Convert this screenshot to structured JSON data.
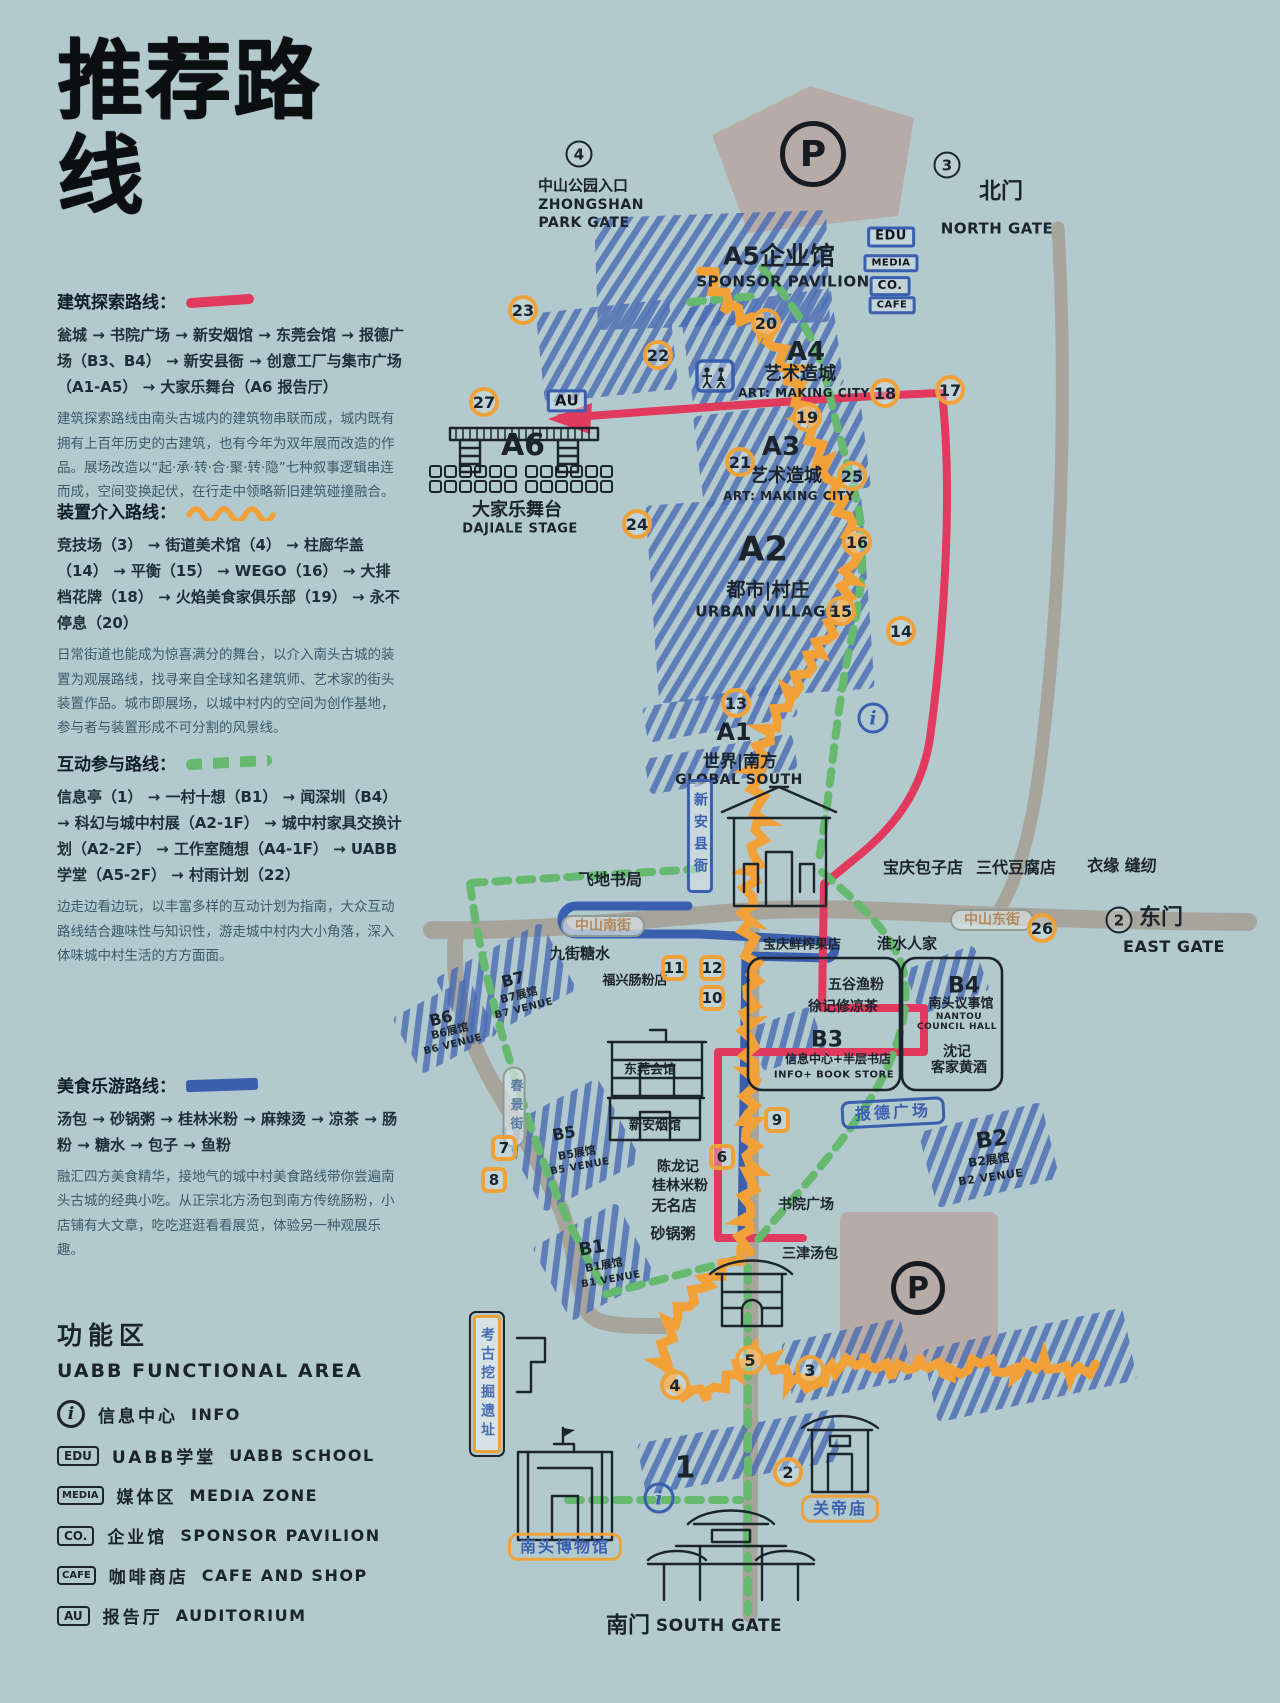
{
  "title": "推荐路线",
  "colors": {
    "background": "#b2c9ce",
    "ink": "#1b242c",
    "route_red": "#e23a5e",
    "route_orange": "#f2a138",
    "route_green": "#66b96f",
    "route_blue": "#3a5fae",
    "hatch_blue": "#4a6cb3",
    "road_gray": "#a7a49b",
    "parking_gray": "#b6aba6",
    "badge_orange": "#f0a23a"
  },
  "routes": [
    {
      "name": "建筑探索路线：",
      "stops": "瓮城 → 书院广场 → 新安烟馆 → 东莞会馆 → 报德广场（B3、B4） → 新安县衙 → 创意工厂与集市广场（A1-A5） → 大家乐舞台（A6 报告厅）",
      "desc": "建筑探索路线由南头古城内的建筑物串联而成，城内既有拥有上百年历史的古建筑，也有今年为双年展而改造的作品。展场改造以“起·承·转·合·聚·转·隐”七种叙事逻辑串连而成，空间变换起伏，在行走中领略新旧建筑碰撞融合。"
    },
    {
      "name": "装置介入路线：",
      "stops": "竞技场（3） → 街道美术馆（4） → 柱廊华盖（14） → 平衡（15） → WEGO（16） → 大排档花牌（18） → 火焰美食家俱乐部（19） → 永不停息（20）",
      "desc": "日常街道也能成为惊喜满分的舞台，以介入南头古城的装置为观展路线，找寻来自全球知名建筑师、艺术家的街头装置作品。城市即展场，以城中村内的空间为创作基地，参与者与装置形成不可分割的风景线。"
    },
    {
      "name": "互动参与路线：",
      "stops": "信息亭（1） → 一村十想（B1） → 闻深圳（B4） → 科幻与城中村展（A2-1F） → 城中村家具交换计划（A2-2F） → 工作室随想（A4-1F） → UABB 学堂（A5-2F） → 村雨计划（22）",
      "desc": "边走边看边玩，以丰富多样的互动计划为指南，大众互动路线结合趣味性与知识性，游走城中村内大小角落，深入体味城中村生活的方方面面。"
    },
    {
      "name": "美食乐游路线：",
      "stops": "汤包 → 砂锅粥 → 桂林米粉 → 麻辣烫 → 凉茶 → 肠粉 → 糖水 → 包子 → 鱼粉",
      "desc": "融汇四方美食精华，接地气的城中村美食路线带你尝遍南头古城的经典小吃。从正宗北方汤包到南方传统肠粉，小店铺有大文章，吃吃逛逛看看展览，体验另一种观展乐趣。"
    }
  ],
  "legend": {
    "title_cn": "功能区",
    "title_en": "UABB FUNCTIONAL AREA",
    "items": [
      {
        "icon": "i",
        "cn": "信息中心",
        "en": "INFO"
      },
      {
        "icon": "EDU",
        "cn": "UABB学堂",
        "en": "UABB SCHOOL"
      },
      {
        "icon": "MEDIA",
        "cn": "媒体区",
        "en": "MEDIA ZONE"
      },
      {
        "icon": "CO.",
        "cn": "企业馆",
        "en": "SPONSOR PAVILION"
      },
      {
        "icon": "CAFE",
        "cn": "咖啡商店",
        "en": "CAFE AND SHOP"
      },
      {
        "icon": "AU",
        "cn": "报告厅",
        "en": "AUDITORIUM"
      }
    ]
  },
  "map": {
    "labels": [
      {
        "t": "中山公园入口",
        "x": 583,
        "y": 186,
        "fs": 15
      },
      {
        "t": "ZHONGSHAN",
        "x": 591,
        "y": 205,
        "fs": 14,
        "cls": "latin"
      },
      {
        "t": "PARK GATE",
        "x": 584,
        "y": 223,
        "fs": 14,
        "cls": "latin"
      },
      {
        "t": "北门",
        "x": 1001,
        "y": 192,
        "fs": 22
      },
      {
        "t": "NORTH GATE",
        "x": 997,
        "y": 229,
        "fs": 15,
        "cls": "latin"
      },
      {
        "t": "A5企业馆",
        "x": 779,
        "y": 257,
        "fs": 25
      },
      {
        "t": "SPONSOR PAVILION",
        "x": 783,
        "y": 282,
        "fs": 15,
        "cls": "latin"
      },
      {
        "t": "EDU",
        "x": 891,
        "y": 237,
        "fs": 13,
        "cls": "fac"
      },
      {
        "t": "MEDIA",
        "x": 891,
        "y": 263,
        "fs": 10,
        "cls": "fac"
      },
      {
        "t": "CO.",
        "x": 890,
        "y": 286,
        "fs": 12,
        "cls": "fac"
      },
      {
        "t": "CAFE",
        "x": 892,
        "y": 305,
        "fs": 10,
        "cls": "fac"
      },
      {
        "t": "A4",
        "x": 806,
        "y": 353,
        "fs": 26
      },
      {
        "t": "艺术造城",
        "x": 800,
        "y": 375,
        "fs": 18
      },
      {
        "t": "ART: MAKING CITY",
        "x": 804,
        "y": 394,
        "fs": 12,
        "cls": "latin"
      },
      {
        "t": "AU",
        "x": 567,
        "y": 401,
        "fs": 15,
        "cls": "fac"
      },
      {
        "t": "A6",
        "x": 523,
        "y": 446,
        "fs": 30
      },
      {
        "t": "大家乐舞台",
        "x": 517,
        "y": 511,
        "fs": 18
      },
      {
        "t": "DAJIALE STAGE",
        "x": 520,
        "y": 530,
        "fs": 13,
        "cls": "latin"
      },
      {
        "t": "A3",
        "x": 781,
        "y": 448,
        "fs": 26
      },
      {
        "t": "艺术造城",
        "x": 786,
        "y": 477,
        "fs": 18
      },
      {
        "t": "ART: MAKING CITY",
        "x": 789,
        "y": 497,
        "fs": 12,
        "cls": "latin"
      },
      {
        "t": "A2",
        "x": 763,
        "y": 550,
        "fs": 34
      },
      {
        "t": "都市|村庄",
        "x": 768,
        "y": 591,
        "fs": 19
      },
      {
        "t": "URBAN VILLAGE",
        "x": 766,
        "y": 612,
        "fs": 15,
        "cls": "latin"
      },
      {
        "t": "A1",
        "x": 734,
        "y": 733,
        "fs": 24
      },
      {
        "t": "世界|南方",
        "x": 740,
        "y": 763,
        "fs": 17
      },
      {
        "t": "GLOBAL SOUTH",
        "x": 739,
        "y": 780,
        "fs": 14,
        "cls": "latin"
      },
      {
        "t": "飞地书局",
        "x": 610,
        "y": 880,
        "fs": 16
      },
      {
        "t": "新安县衙",
        "x": 700,
        "y": 836,
        "fs": 14,
        "cls": "bannerb"
      },
      {
        "t": "宝庆包子店",
        "x": 923,
        "y": 868,
        "fs": 16
      },
      {
        "t": "三代豆腐店",
        "x": 1016,
        "y": 868,
        "fs": 16
      },
      {
        "t": "衣缘 缝纫",
        "x": 1122,
        "y": 866,
        "fs": 16
      },
      {
        "t": "东门",
        "x": 1161,
        "y": 918,
        "fs": 22
      },
      {
        "t": "EAST GATE",
        "x": 1174,
        "y": 947,
        "fs": 16,
        "cls": "latin"
      },
      {
        "t": "中山东街",
        "x": 992,
        "y": 920,
        "fs": 14,
        "cls": "oval"
      },
      {
        "t": "中山南街",
        "x": 603,
        "y": 926,
        "fs": 14,
        "cls": "oval"
      },
      {
        "t": "九街糖水",
        "x": 580,
        "y": 954,
        "fs": 15
      },
      {
        "t": "淮水人家",
        "x": 907,
        "y": 944,
        "fs": 15
      },
      {
        "t": "宝庆鲜榨果店",
        "x": 802,
        "y": 946,
        "fs": 13
      },
      {
        "t": "福兴肠粉店",
        "x": 635,
        "y": 982,
        "fs": 13
      },
      {
        "t": "五谷渔粉",
        "x": 856,
        "y": 985,
        "fs": 14
      },
      {
        "t": "徐记修凉茶",
        "x": 843,
        "y": 1007,
        "fs": 14
      },
      {
        "t": "B4",
        "x": 964,
        "y": 986,
        "fs": 22
      },
      {
        "t": "南头议事馆",
        "x": 961,
        "y": 1005,
        "fs": 13
      },
      {
        "t": "NANTOU",
        "x": 959,
        "y": 1017,
        "fs": 9,
        "cls": "latin"
      },
      {
        "t": "COUNCIL HALL",
        "x": 957,
        "y": 1027,
        "fs": 9,
        "cls": "latin"
      },
      {
        "t": "沈记",
        "x": 957,
        "y": 1052,
        "fs": 14
      },
      {
        "t": "客家黄酒",
        "x": 959,
        "y": 1068,
        "fs": 14
      },
      {
        "t": "B3",
        "x": 827,
        "y": 1040,
        "fs": 22
      },
      {
        "t": "信息中心+半层书店",
        "x": 838,
        "y": 1060,
        "fs": 12
      },
      {
        "t": "INFO+ BOOK STORE",
        "x": 834,
        "y": 1075,
        "fs": 10,
        "cls": "latin"
      },
      {
        "t": "报德广场",
        "x": 893,
        "y": 1113,
        "fs": 16,
        "cls": "plateb",
        "r": -3
      },
      {
        "t": "B2",
        "x": 992,
        "y": 1140,
        "fs": 22,
        "r": -8
      },
      {
        "t": "B2展馆",
        "x": 989,
        "y": 1161,
        "fs": 12,
        "r": -8
      },
      {
        "t": "B2 VENUE",
        "x": 991,
        "y": 1178,
        "fs": 11,
        "cls": "latin",
        "r": -8
      },
      {
        "t": "B7",
        "x": 513,
        "y": 980,
        "fs": 16,
        "r": -14
      },
      {
        "t": "B7展馆",
        "x": 519,
        "y": 996,
        "fs": 11,
        "r": -14
      },
      {
        "t": "B7 VENUE",
        "x": 524,
        "y": 1009,
        "fs": 10,
        "cls": "latin",
        "r": -14
      },
      {
        "t": "B6",
        "x": 441,
        "y": 1019,
        "fs": 16,
        "r": -14
      },
      {
        "t": "B6展馆",
        "x": 450,
        "y": 1032,
        "fs": 11,
        "r": -14
      },
      {
        "t": "B6 VENUE",
        "x": 453,
        "y": 1045,
        "fs": 10,
        "cls": "latin",
        "r": -14
      },
      {
        "t": "春景街",
        "x": 514,
        "y": 1107,
        "fs": 13,
        "cls": "ovalv"
      },
      {
        "t": "B5",
        "x": 564,
        "y": 1134,
        "fs": 16,
        "r": -10
      },
      {
        "t": "B5展馆",
        "x": 577,
        "y": 1154,
        "fs": 11,
        "r": -10
      },
      {
        "t": "B5 VENUE",
        "x": 580,
        "y": 1167,
        "fs": 10,
        "cls": "latin",
        "r": -10
      },
      {
        "t": "东莞会馆",
        "x": 650,
        "y": 1071,
        "fs": 13
      },
      {
        "t": "新安烟馆",
        "x": 655,
        "y": 1127,
        "fs": 13
      },
      {
        "t": "陈龙记",
        "x": 678,
        "y": 1167,
        "fs": 14
      },
      {
        "t": "桂林米粉",
        "x": 680,
        "y": 1186,
        "fs": 14
      },
      {
        "t": "无名店",
        "x": 674,
        "y": 1206,
        "fs": 15
      },
      {
        "t": "砂锅粥",
        "x": 673,
        "y": 1234,
        "fs": 15
      },
      {
        "t": "B1",
        "x": 592,
        "y": 1249,
        "fs": 18,
        "r": -10
      },
      {
        "t": "B1展馆",
        "x": 604,
        "y": 1266,
        "fs": 11,
        "r": -10
      },
      {
        "t": "B1 VENUE",
        "x": 611,
        "y": 1280,
        "fs": 10,
        "cls": "latin",
        "r": -10
      },
      {
        "t": "书院广场",
        "x": 806,
        "y": 1205,
        "fs": 14
      },
      {
        "t": "三津汤包",
        "x": 810,
        "y": 1254,
        "fs": 14
      },
      {
        "t": "考古挖掘遗址",
        "x": 487,
        "y": 1384,
        "fs": 14,
        "cls": "bannero"
      },
      {
        "t": "南头博物馆",
        "x": 565,
        "y": 1547,
        "fs": 16,
        "cls": "plateo"
      },
      {
        "t": "关帝庙",
        "x": 840,
        "y": 1509,
        "fs": 16,
        "cls": "plateo"
      },
      {
        "t": "南门",
        "x": 628,
        "y": 1626,
        "fs": 22
      },
      {
        "t": "SOUTH GATE",
        "x": 719,
        "y": 1627,
        "fs": 17,
        "cls": "latin"
      }
    ],
    "markers": [
      {
        "t": "4",
        "type": "g",
        "x": 579,
        "y": 154
      },
      {
        "t": "3",
        "type": "g",
        "x": 947,
        "y": 165
      },
      {
        "t": "2",
        "type": "g",
        "x": 1119,
        "y": 920
      },
      {
        "t": "P",
        "type": "P",
        "x": 813,
        "y": 154,
        "w": 66
      },
      {
        "t": "P",
        "type": "P",
        "x": 918,
        "y": 1288,
        "w": 54
      },
      {
        "t": "i",
        "type": "i",
        "x": 873,
        "y": 718
      },
      {
        "t": "i",
        "type": "i",
        "x": 659,
        "y": 1498
      },
      {
        "t": "20",
        "type": "c",
        "x": 766,
        "y": 323
      },
      {
        "t": "22",
        "type": "c",
        "x": 658,
        "y": 355
      },
      {
        "t": "23",
        "type": "c",
        "x": 523,
        "y": 310
      },
      {
        "t": "27",
        "type": "c",
        "x": 484,
        "y": 402
      },
      {
        "t": "19",
        "type": "c",
        "x": 807,
        "y": 417
      },
      {
        "t": "18",
        "type": "c",
        "x": 885,
        "y": 393
      },
      {
        "t": "17",
        "type": "c",
        "x": 950,
        "y": 390
      },
      {
        "t": "21",
        "type": "c",
        "x": 740,
        "y": 462
      },
      {
        "t": "25",
        "type": "c",
        "x": 852,
        "y": 476
      },
      {
        "t": "24",
        "type": "c",
        "x": 637,
        "y": 524
      },
      {
        "t": "16",
        "type": "c",
        "x": 857,
        "y": 542
      },
      {
        "t": "15",
        "type": "c",
        "x": 841,
        "y": 611
      },
      {
        "t": "14",
        "type": "c",
        "x": 901,
        "y": 631
      },
      {
        "t": "13",
        "type": "c",
        "x": 736,
        "y": 703
      },
      {
        "t": "26",
        "type": "c",
        "x": 1042,
        "y": 928
      },
      {
        "t": "2",
        "type": "c",
        "x": 788,
        "y": 1472
      },
      {
        "t": "3",
        "type": "c",
        "x": 810,
        "y": 1370
      },
      {
        "t": "4",
        "type": "c",
        "x": 675,
        "y": 1385
      },
      {
        "t": "5",
        "type": "c",
        "x": 750,
        "y": 1360
      },
      {
        "t": "6",
        "type": "s",
        "x": 722,
        "y": 1157
      },
      {
        "t": "7",
        "type": "s",
        "x": 504,
        "y": 1148
      },
      {
        "t": "8",
        "type": "s",
        "x": 494,
        "y": 1180
      },
      {
        "t": "9",
        "type": "s",
        "x": 777,
        "y": 1120
      },
      {
        "t": "10",
        "type": "s",
        "x": 712,
        "y": 998
      },
      {
        "t": "11",
        "type": "s",
        "x": 674,
        "y": 968
      },
      {
        "t": "12",
        "type": "s",
        "x": 712,
        "y": 968
      },
      {
        "t": "1",
        "type": "p",
        "x": 685,
        "y": 1468
      }
    ]
  }
}
